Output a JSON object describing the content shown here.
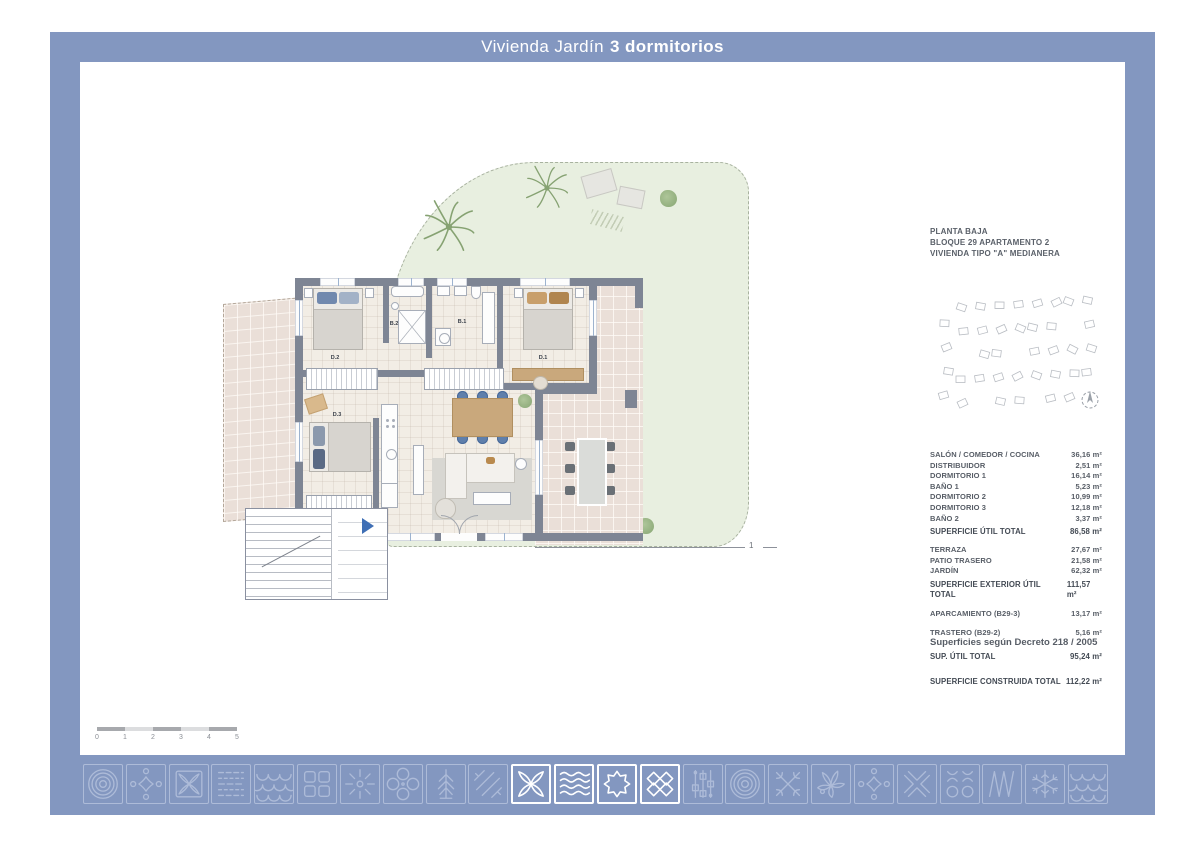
{
  "title": {
    "regular": "Vivienda Jardín",
    "bold": "3 dormitorios"
  },
  "plan_header": {
    "line1": "PLANTA BAJA",
    "line2": "BLOQUE 29 APARTAMENTO 2",
    "line3": "VIVIENDA TIPO \"A\" MEDIANERA"
  },
  "rooms": {
    "d2": "D.2",
    "b2": "B.2",
    "b1": "B.1",
    "d1": "D.1",
    "d3": "D.3"
  },
  "section_marker": "1",
  "scale_bar": {
    "ticks": [
      "0",
      "1",
      "2",
      "3",
      "4",
      "5"
    ]
  },
  "areas": {
    "interior": [
      {
        "label": "SALÓN / COMEDOR / COCINA",
        "value": "36,16 m²"
      },
      {
        "label": "DISTRIBUIDOR",
        "value": "2,51 m²"
      },
      {
        "label": "DORMITORIO 1",
        "value": "16,14 m²"
      },
      {
        "label": "BAÑO 1",
        "value": "5,23 m²"
      },
      {
        "label": "DORMITORIO 2",
        "value": "10,99 m²"
      },
      {
        "label": "DORMITORIO 3",
        "value": "12,18 m²"
      },
      {
        "label": "BAÑO 2",
        "value": "3,37 m²"
      },
      {
        "label": "SUPERFICIE ÚTIL TOTAL",
        "value": "86,58 m²",
        "bold": true
      }
    ],
    "exterior": [
      {
        "label": "TERRAZA",
        "value": "27,67 m²"
      },
      {
        "label": "PATIO TRASERO",
        "value": "21,58 m²"
      },
      {
        "label": "JARDÍN",
        "value": "62,32 m²"
      },
      {
        "label": "SUPERFICIE EXTERIOR ÚTIL TOTAL",
        "value": "111,57 m²",
        "bold": true
      },
      {
        "label": "APARCAMIENTO (B29-3)",
        "value": "13,17 m²",
        "gap": true
      },
      {
        "label": "TRASTERO (B29-2)",
        "value": "5,16 m²",
        "gap": true
      }
    ],
    "decree_note": "Superficies según Decreto 218 / 2005",
    "sup_util": {
      "label": "SUP. ÚTIL TOTAL",
      "value": "95,24 m²"
    },
    "constructed": {
      "label": "SUPERFICIE CONSTRUIDA TOTAL",
      "value": "112,22 m²"
    }
  },
  "footer": {
    "icons": [
      {
        "name": "concentric-rings",
        "highlight": false
      },
      {
        "name": "star-dots",
        "highlight": false
      },
      {
        "name": "quatrefoil",
        "highlight": false
      },
      {
        "name": "dashed-lines",
        "highlight": false
      },
      {
        "name": "fish-scales",
        "highlight": false
      },
      {
        "name": "four-squares",
        "highlight": false
      },
      {
        "name": "ray-burst",
        "highlight": false
      },
      {
        "name": "four-circles",
        "highlight": false
      },
      {
        "name": "pine-tree",
        "highlight": false
      },
      {
        "name": "diagonal-hatch",
        "highlight": false
      },
      {
        "name": "petal-cross",
        "highlight": true
      },
      {
        "name": "waves",
        "highlight": true
      },
      {
        "name": "eight-point-star",
        "highlight": true
      },
      {
        "name": "diamond-lattice",
        "highlight": true
      },
      {
        "name": "slider-beads",
        "highlight": false
      },
      {
        "name": "concentric-rings-2",
        "highlight": false
      },
      {
        "name": "cross-weave",
        "highlight": false
      },
      {
        "name": "palm-leaves",
        "highlight": false
      },
      {
        "name": "star-dots-2",
        "highlight": false
      },
      {
        "name": "chevron-cross",
        "highlight": false
      },
      {
        "name": "circle-grid",
        "highlight": false
      },
      {
        "name": "zigzag-lines",
        "highlight": false
      },
      {
        "name": "snowflake",
        "highlight": false
      },
      {
        "name": "fish-scales-2",
        "highlight": false
      }
    ]
  },
  "colors": {
    "frame_blue": "#8397c0",
    "icon_muted": "#adbbd8",
    "icon_highlight": "#ffffff",
    "wall_gray": "#7e8594",
    "garden_green": "#e8efe0",
    "tile_pink": "#eadfd8",
    "wood": "#c9a87c",
    "accent_blue": "#5f7fab",
    "entrance_arrow": "#3f6fb5"
  }
}
